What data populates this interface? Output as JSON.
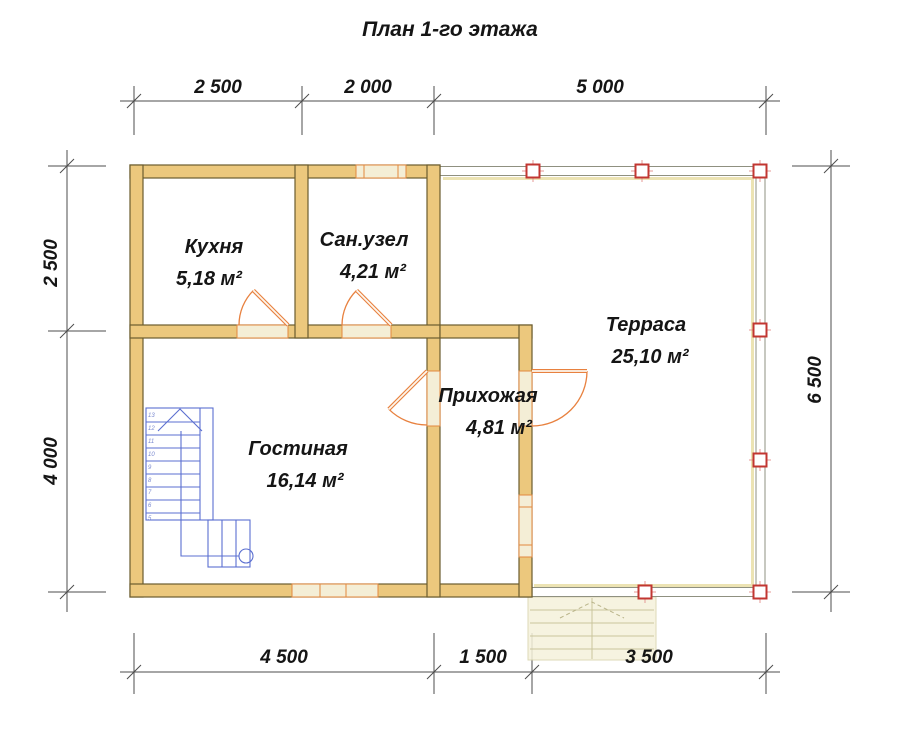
{
  "title": "План 1-го этажа",
  "dimensions": {
    "top": [
      "2 500",
      "2 000",
      "5 000"
    ],
    "bottom": [
      "4 500",
      "1 500",
      "3 500"
    ],
    "left": [
      "2 500",
      "4 000"
    ],
    "right": [
      "6 500"
    ]
  },
  "rooms": [
    {
      "name": "Кухня",
      "area": "5,18 м²"
    },
    {
      "name": "Сан.узел",
      "area": "4,21 м²"
    },
    {
      "name": "Терраса",
      "area": "25,10 м²"
    },
    {
      "name": "Прихожая",
      "area": "4,81 м²"
    },
    {
      "name": "Гостиная",
      "area": "16,14 м²"
    }
  ],
  "stairs": {
    "step_numbers": [
      "13",
      "12",
      "11",
      "10",
      "9",
      "8",
      "7",
      "6",
      "5"
    ]
  },
  "colors": {
    "wall_fill": "#ecc87d",
    "wall_outline": "#6b5c2e",
    "opening_fill": "#f4eed6",
    "door_accent": "#e8813f",
    "window_frame": "#e2883f",
    "terrace_wall": "#8f9080",
    "terrace_accent": "#ece3b3",
    "column_red": "#c23631",
    "stairs_blue": "#5b6fd0",
    "dimension_line": "#4d4d4d",
    "text": "#151515"
  }
}
